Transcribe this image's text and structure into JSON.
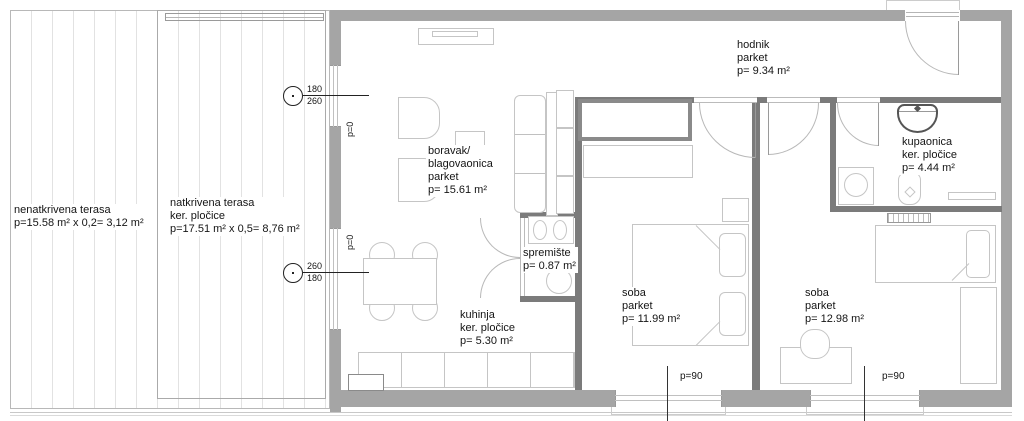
{
  "plan": {
    "areas": {
      "nenatkrivena_terasa": [
        "nenatkrivena terasa",
        "p=15.58 m² x 0,2= 3,12 m²"
      ],
      "natkrivena_terasa": [
        "natkrivena terasa",
        "ker. pločice",
        "p=17.51 m² x 0,5= 8,76 m²"
      ],
      "boravak": [
        "boravak/",
        "blagovaonica",
        "parket",
        "p= 15.61 m²"
      ],
      "hodnik": [
        "hodnik",
        "parket",
        "p= 9.34 m²"
      ],
      "kupaonica": [
        "kupaonica",
        "ker. pločice",
        "p= 4.44 m²"
      ],
      "spremiste": [
        "spremište",
        "p= 0.87 m²"
      ],
      "kuhinja": [
        "kuhinja",
        "ker. pločice",
        "p= 5.30 m²"
      ],
      "soba_1": [
        "soba",
        "parket",
        "p= 11.99 m²"
      ],
      "soba_2": [
        "soba",
        "parket",
        "p= 12.98 m²"
      ]
    },
    "openings": {
      "window_top_marker": {
        "upper": "180",
        "lower": "260"
      },
      "window_bottom_marker": {
        "upper": "260",
        "lower": "180"
      },
      "parapet_zero_top": "p=0",
      "parapet_zero_bottom": "p=0",
      "parapet_window_1": "p=90",
      "parapet_window_2": "p=90"
    },
    "colors": {
      "outer_wall": "#a5a5a5",
      "inner_wall": "#7b7b7b",
      "furniture_line": "#c5c5c5",
      "hatch_line": "#e2e2e2",
      "annotation": "#151515"
    }
  }
}
